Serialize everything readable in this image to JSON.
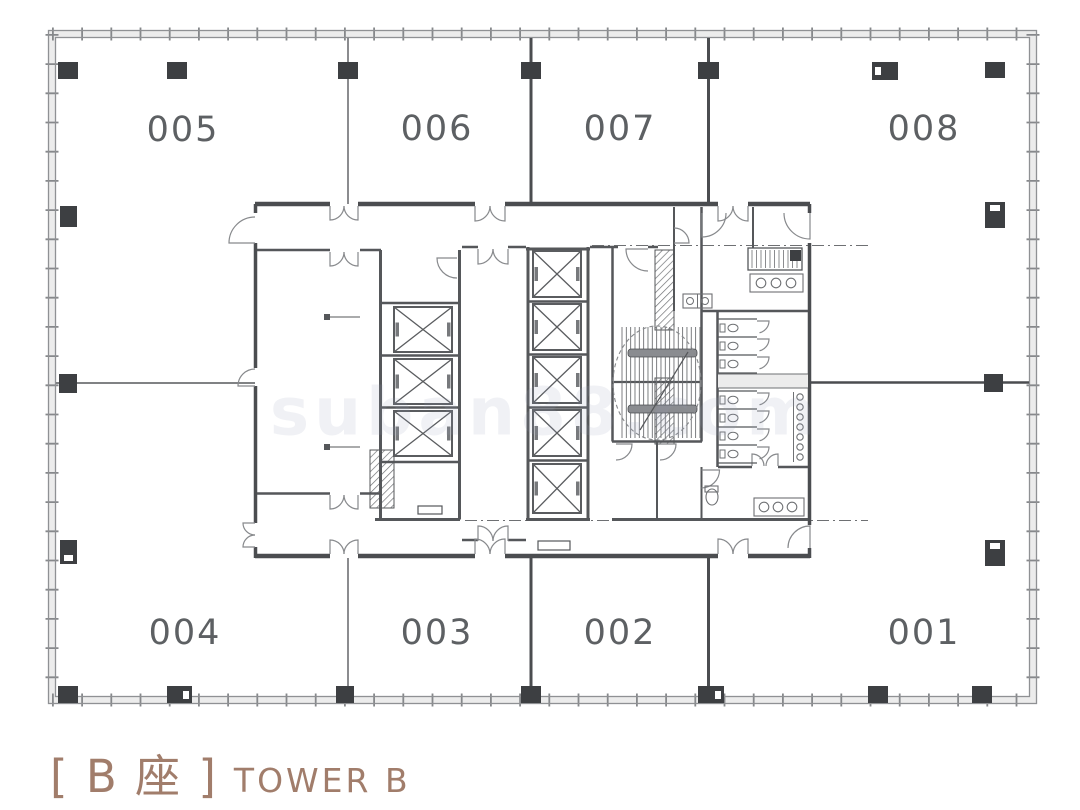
{
  "title": {
    "bracket_cn": "[ B 座 ]",
    "tower_en": "TOWER B"
  },
  "watermark": {
    "text": "suban88.com"
  },
  "units": {
    "top": [
      {
        "id": "005",
        "x": 183,
        "y": 130
      },
      {
        "id": "006",
        "x": 437,
        "y": 129
      },
      {
        "id": "007",
        "x": 620,
        "y": 129
      },
      {
        "id": "008",
        "x": 924,
        "y": 129
      }
    ],
    "bottom": [
      {
        "id": "004",
        "x": 185,
        "y": 633
      },
      {
        "id": "003",
        "x": 437,
        "y": 633
      },
      {
        "id": "002",
        "x": 620,
        "y": 633
      },
      {
        "id": "001",
        "x": 924,
        "y": 633
      }
    ]
  },
  "colors": {
    "wall_dark": "#4b4d50",
    "wall_mid": "#55575a",
    "line": "#6e7073",
    "tick": "#86888b",
    "band": "#ececec",
    "edge": "#8f9194",
    "arc": "#87898c",
    "shaft": "#5a5c5f",
    "rail": "#77797c",
    "column": "#3d3f42",
    "label": "#5d6063",
    "title": "#a17d6b",
    "watermark": "#98a0ba",
    "bar": "#8a8c90"
  },
  "plan": {
    "outer": {
      "band": [
        48.5,
        30.5,
        988,
        673
      ],
      "inner": [
        55.5,
        37.5,
        974,
        659
      ],
      "center": [
        [
          52,
          34,
          1033,
          34
        ],
        [
          52,
          700,
          1033,
          700
        ],
        [
          52,
          34,
          52,
          700
        ],
        [
          1033,
          34,
          1033,
          700
        ]
      ]
    },
    "dashdot": [
      [
        592,
        245.5,
        868,
        245.5
      ],
      [
        465,
        520.5,
        868,
        520.5
      ]
    ],
    "dividers": [
      [
        348,
        38,
        348,
        204,
        1.6,
        "line"
      ],
      [
        531,
        38,
        531,
        204,
        3,
        "wall_dark"
      ],
      [
        708.5,
        38,
        708.5,
        204,
        3,
        "wall_dark"
      ],
      [
        348,
        558,
        348,
        696,
        1.6,
        "line"
      ],
      [
        531,
        558,
        531,
        696,
        3,
        "wall_dark"
      ],
      [
        708.5,
        558,
        708.5,
        696,
        3,
        "wall_dark"
      ],
      [
        56,
        383,
        255,
        383,
        1.8,
        "line"
      ],
      [
        810,
        382.5,
        1029,
        382.5,
        2.6,
        "wall_dark"
      ]
    ],
    "walls": {
      "core": [
        [
          255,
          204,
          330,
          204,
          4.5
        ],
        [
          358,
          204,
          475,
          204,
          4.5
        ],
        [
          505,
          204,
          718,
          204,
          4.5
        ],
        [
          748,
          204,
          810,
          204,
          4.5
        ],
        [
          255,
          556,
          330,
          556,
          4.5
        ],
        [
          358,
          556,
          475,
          556,
          4.5
        ],
        [
          505,
          556,
          718,
          556,
          4.5
        ],
        [
          748,
          556,
          810,
          556,
          4.5
        ],
        [
          255.5,
          204,
          255.5,
          213,
          3.5
        ],
        [
          255.5,
          243,
          255.5,
          368,
          3.5
        ],
        [
          255.5,
          386,
          255.5,
          523,
          3.5
        ],
        [
          255.5,
          547,
          255.5,
          558,
          3.5
        ],
        [
          809.5,
          204,
          809.5,
          213,
          3.5
        ],
        [
          809.5,
          243,
          809.5,
          525,
          3.5
        ],
        [
          809.5,
          548,
          809.5,
          558,
          3.5
        ]
      ],
      "mid": [
        [
          257,
          250,
          330,
          250,
          2.5
        ],
        [
          360,
          250,
          381,
          250,
          2.5
        ],
        [
          257,
          493.5,
          330,
          493.5,
          2.5
        ],
        [
          360,
          493.5,
          381,
          493.5,
          2.5
        ],
        [
          380.5,
          250,
          380.5,
          519.5,
          3
        ],
        [
          459.5,
          250,
          459.5,
          519.5,
          3
        ],
        [
          380,
          303,
          460,
          303,
          2.5
        ],
        [
          380,
          355.5,
          460,
          355.5,
          2.5
        ],
        [
          380,
          407.5,
          460,
          407.5,
          2.5
        ],
        [
          380,
          462,
          460,
          462,
          2.5
        ],
        [
          375,
          519.5,
          460,
          519.5,
          3
        ],
        [
          462,
          247,
          478,
          247,
          2.5
        ],
        [
          508,
          247,
          526,
          247,
          2.5
        ],
        [
          462,
          540,
          478,
          540,
          2.5
        ],
        [
          508,
          540,
          526,
          540,
          2.5
        ],
        [
          528,
          247,
          528,
          519.5,
          3
        ],
        [
          588,
          247,
          588,
          519.5,
          3
        ],
        [
          526,
          249,
          590,
          249,
          3
        ],
        [
          526,
          519.5,
          590,
          519.5,
          3
        ],
        [
          528,
          301.5,
          588,
          301.5,
          2.5
        ],
        [
          528,
          354.5,
          588,
          354.5,
          2.5
        ],
        [
          528,
          407.5,
          588,
          407.5,
          2.5
        ],
        [
          528,
          460.5,
          588,
          460.5,
          2.5
        ],
        [
          590,
          247,
          618,
          247,
          2.5
        ],
        [
          648,
          247,
          658,
          247,
          2.5
        ],
        [
          612.5,
          247,
          612.5,
          441.5,
          2.5
        ],
        [
          701.5,
          207,
          701.5,
          441.5,
          2.5
        ],
        [
          612,
          441.5,
          702,
          441.5,
          2.5
        ],
        [
          612,
          519.5,
          808,
          519.5,
          3
        ],
        [
          702,
          311,
          808,
          311,
          2.5
        ],
        [
          717.5,
          311,
          717.5,
          467,
          2.5
        ],
        [
          718,
          467,
          752,
          467,
          2.5
        ],
        [
          778,
          467,
          808,
          467,
          2.5
        ],
        [
          657,
          441.5,
          657,
          519.5,
          2
        ],
        [
          701.5,
          467,
          701.5,
          519.5,
          2
        ],
        [
          753,
          207,
          753,
          248,
          2
        ],
        [
          674,
          207,
          674,
          311,
          2
        ],
        [
          614,
          382,
          700,
          382,
          2.2
        ]
      ],
      "thin": [
        [
          793.5,
          392,
          793.5,
          462,
          1
        ]
      ]
    },
    "hatches": [
      [
        655,
        250,
        19,
        80
      ],
      [
        655,
        378,
        19,
        66
      ],
      [
        370,
        450,
        24,
        58
      ]
    ],
    "shafts": {
      "bank1": [
        [
          394,
          307,
          58,
          45
        ],
        [
          394,
          359,
          58,
          45
        ],
        [
          394,
          411,
          58,
          45
        ]
      ],
      "bank2": [
        [
          533,
          251,
          48,
          46
        ],
        [
          533,
          304,
          48,
          46
        ],
        [
          533,
          357,
          48,
          46
        ],
        [
          533,
          410,
          48,
          46
        ],
        [
          533,
          464,
          48,
          49
        ]
      ]
    },
    "stair": {
      "treads": {
        "x0": 622,
        "x1": 700,
        "step": 4.33,
        "y0": 327,
        "y1": 438
      },
      "bars": [
        [
          628,
          349,
          69,
          8
        ],
        [
          628,
          405,
          69,
          8
        ]
      ],
      "ellipse": [
        657,
        383,
        44,
        57
      ],
      "diag": [
        640,
        430,
        688,
        352
      ]
    },
    "doors": [
      [
        330,
        206,
        14,
        90,
        0
      ],
      [
        358,
        206,
        14,
        90,
        180
      ],
      [
        475,
        206,
        15,
        90,
        0
      ],
      [
        505,
        206,
        15,
        90,
        180
      ],
      [
        718,
        206,
        15,
        90,
        0
      ],
      [
        748,
        206,
        15,
        90,
        180
      ],
      [
        330,
        554,
        14,
        -90,
        0
      ],
      [
        358,
        554,
        14,
        -90,
        -180
      ],
      [
        475,
        554,
        15,
        -90,
        0
      ],
      [
        505,
        554,
        15,
        -90,
        -180
      ],
      [
        718,
        554,
        15,
        -90,
        0
      ],
      [
        748,
        554,
        15,
        -90,
        -180
      ],
      [
        255,
        243,
        26,
        180,
        270
      ],
      [
        255,
        386,
        17,
        180,
        270
      ],
      [
        255,
        523,
        12,
        180,
        90
      ],
      [
        255,
        547,
        12,
        180,
        270
      ],
      [
        810,
        213,
        26,
        90,
        180
      ],
      [
        810,
        548,
        22,
        270,
        180
      ],
      [
        330,
        252,
        14,
        90,
        0
      ],
      [
        358,
        252,
        14,
        90,
        180
      ],
      [
        330,
        495,
        14,
        90,
        0
      ],
      [
        358,
        495,
        14,
        90,
        180
      ],
      [
        478,
        249,
        15,
        90,
        0
      ],
      [
        508,
        249,
        15,
        90,
        180
      ],
      [
        478,
        541,
        15,
        -90,
        0
      ],
      [
        508,
        541,
        15,
        -90,
        -180
      ],
      [
        457,
        258,
        20,
        180,
        90
      ],
      [
        648,
        249,
        22,
        180,
        90
      ],
      [
        616,
        444,
        16,
        0,
        90
      ],
      [
        660,
        444,
        16,
        0,
        90
      ],
      [
        752,
        466,
        12,
        -90,
        0
      ],
      [
        778,
        466,
        12,
        -90,
        -180
      ],
      [
        701.5,
        470,
        18,
        0,
        90
      ],
      [
        702,
        213,
        24,
        90,
        0
      ],
      [
        674,
        243,
        15,
        0,
        -90
      ],
      [
        757,
        321,
        12,
        0,
        78
      ],
      [
        757,
        339,
        12,
        0,
        78
      ],
      [
        757,
        357,
        12,
        0,
        78
      ],
      [
        757,
        393,
        12,
        0,
        78
      ],
      [
        757,
        411,
        12,
        0,
        78
      ],
      [
        757,
        429,
        12,
        0,
        78
      ],
      [
        757,
        447,
        12,
        0,
        78
      ]
    ],
    "stall_lines": {
      "x0": 718,
      "x1": 757,
      "upper": [
        319,
        337,
        355,
        373
      ],
      "lower": [
        391,
        409,
        427,
        445,
        463
      ]
    },
    "mid_band": {
      "rect": [
        718,
        374,
        90,
        14
      ],
      "edges": [
        [
          718,
          374,
          808,
          374
        ],
        [
          718,
          388,
          808,
          388
        ]
      ]
    },
    "fixtures": {
      "equip": {
        "rect": [
          748,
          248,
          54,
          22
        ],
        "dark": [
          790,
          250,
          11,
          11
        ],
        "hatch_step": 4.5
      },
      "counters": [
        [
          750,
          274,
          53,
          18
        ],
        [
          754,
          498,
          50,
          18
        ]
      ],
      "basins": [
        [
          761,
          283
        ],
        [
          776,
          283
        ],
        [
          791,
          283
        ],
        [
          764,
          507
        ],
        [
          778,
          507
        ],
        [
          792,
          507
        ]
      ],
      "basin_r": 4.8,
      "pair_sink": {
        "rect": [
          683,
          294,
          29,
          14
        ],
        "circles": [
          [
            690,
            301
          ],
          [
            705,
            301
          ]
        ],
        "r": 3.5
      },
      "urinals": {
        "cx": 800,
        "cy": [
          397,
          407,
          417,
          427,
          437,
          447,
          457
        ],
        "r": 3.2
      },
      "toilets": {
        "cx": 733,
        "cy": [
          328,
          346,
          364,
          400,
          418,
          436,
          454
        ],
        "rx": 5,
        "ry": 3.8
      },
      "acc_toilet": {
        "ellipse": [
          712,
          497,
          6,
          8
        ],
        "rect": [
          705,
          486,
          13,
          6
        ]
      },
      "pit": [
        538,
        541,
        32,
        9
      ],
      "bench": [
        418,
        506,
        24,
        8
      ],
      "leaders": [
        [
          327,
          317
        ],
        [
          327,
          447
        ]
      ]
    },
    "columns": [
      [
        58,
        62,
        20,
        17,
        ""
      ],
      [
        167,
        62,
        20,
        17,
        ""
      ],
      [
        338,
        62,
        20,
        17,
        ""
      ],
      [
        521,
        62,
        20,
        17,
        ""
      ],
      [
        698,
        62,
        21,
        17,
        ""
      ],
      [
        872,
        62,
        26,
        18,
        "L"
      ],
      [
        985,
        62,
        20,
        16,
        ""
      ],
      [
        58,
        686,
        20,
        17,
        ""
      ],
      [
        167,
        686,
        25,
        17,
        "R"
      ],
      [
        336,
        686,
        18,
        17,
        ""
      ],
      [
        521,
        686,
        20,
        17,
        ""
      ],
      [
        698,
        686,
        26,
        17,
        "R"
      ],
      [
        868,
        686,
        20,
        17,
        ""
      ],
      [
        972,
        686,
        20,
        17,
        ""
      ],
      [
        60,
        206,
        17,
        21,
        ""
      ],
      [
        59,
        374,
        18,
        19,
        ""
      ],
      [
        60,
        540,
        17,
        24,
        "B"
      ],
      [
        985,
        202,
        20,
        26,
        "T"
      ],
      [
        984,
        374,
        19,
        18,
        ""
      ],
      [
        985,
        540,
        20,
        26,
        "T"
      ]
    ]
  }
}
